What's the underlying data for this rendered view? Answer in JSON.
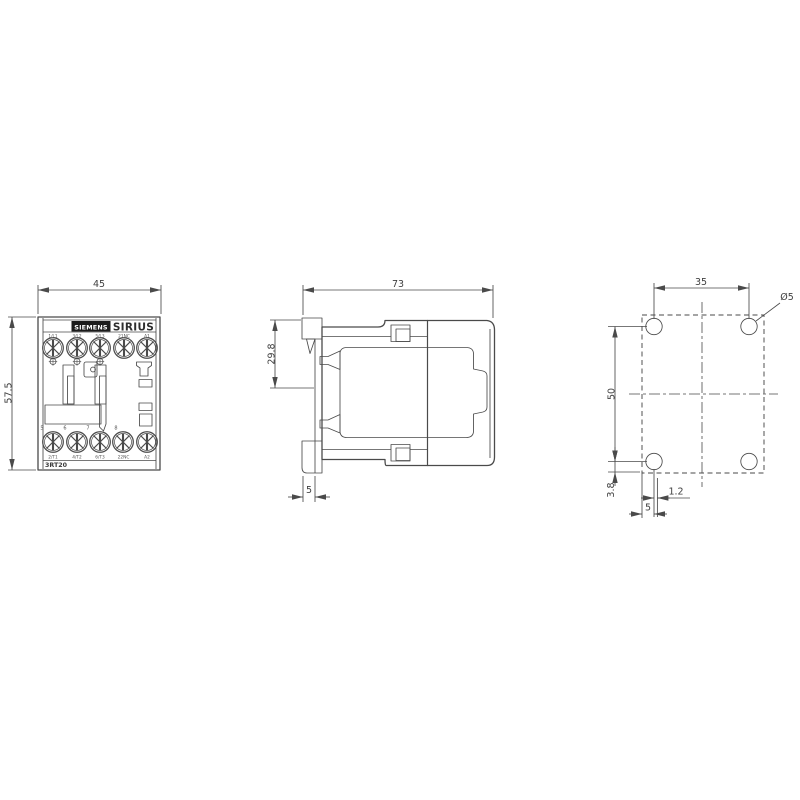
{
  "front_view": {
    "dim_width": "45",
    "dim_height": "57.5",
    "brand": "SIEMENS",
    "series": "SIRIUS",
    "type_code": "3RT20",
    "top_terminal_labels": [
      "1/L1",
      "3/L2",
      "5/L3",
      "21NC",
      "A1"
    ],
    "slot_numbers": [
      "5",
      "6",
      "7",
      "8"
    ],
    "bottom_terminal_labels": [
      "2/T1",
      "4/T2",
      "6/T3",
      "22NC",
      "A2"
    ]
  },
  "side_view": {
    "dim_depth": "73",
    "dim_rail_center": "29.8",
    "dim_clip": "5"
  },
  "mounting_view": {
    "dim_hole_spacing_horizontal": "35",
    "dim_hole_spacing_vertical": "50",
    "hole_diameter": "Ø5",
    "dim_edge_vertical": "3.8",
    "dim_offset": "1.2",
    "dim_edge_horizontal": "5"
  },
  "colors": {
    "line": "#4a4a4a",
    "text": "#3f3f3f",
    "brand_box": "#1b1b1b",
    "background": "#ffffff"
  }
}
